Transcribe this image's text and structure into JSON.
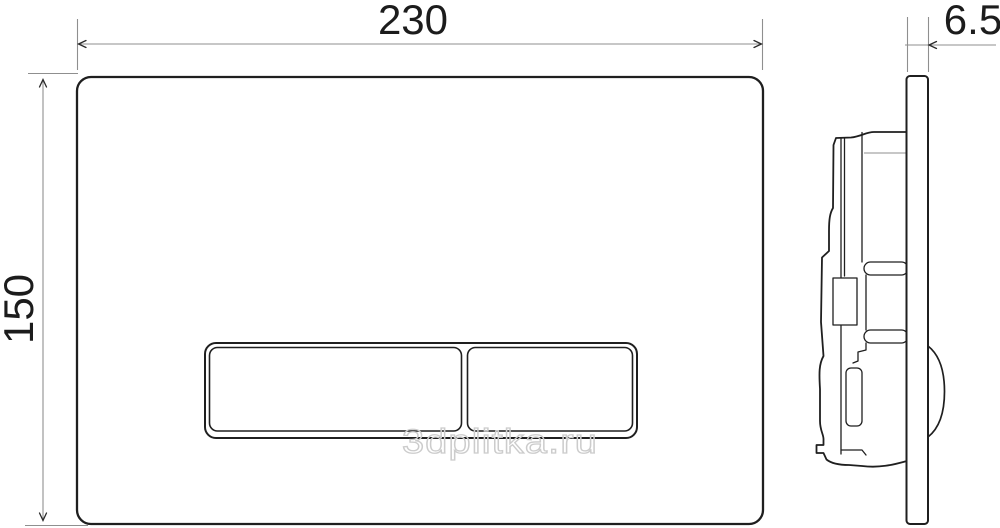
{
  "drawing": {
    "type": "technical-dimension-drawing",
    "subject": "toilet flush plate, front view and side profile view",
    "watermark": "3dplitka.ru",
    "dimensions": {
      "width": "230",
      "height": "150",
      "depth": "6.5"
    },
    "views": {
      "front": "flush plate with two rectangular buttons",
      "side": "plate profile with concealed cistern mechanism and button dome"
    },
    "colors": {
      "background": "#ffffff",
      "outline": "#1f1f1f",
      "dimension_line": "#8f8f8f",
      "watermark": "#cccccc"
    }
  }
}
